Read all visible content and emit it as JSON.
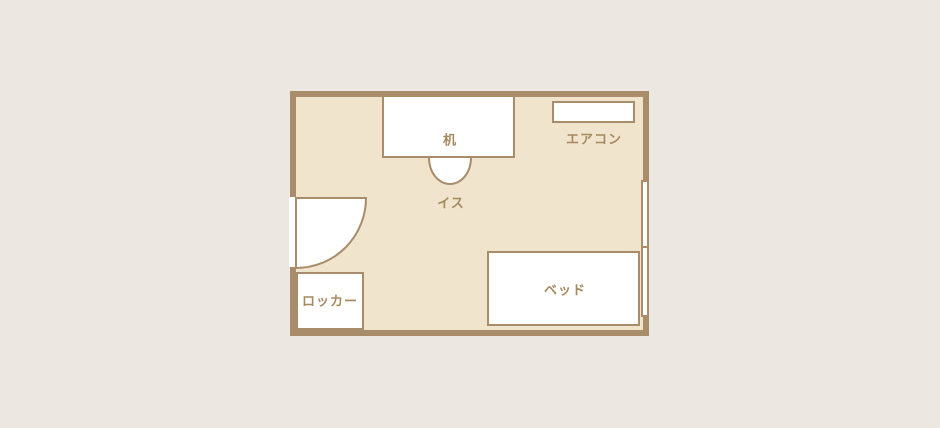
{
  "palette": {
    "page_background": "#ECE8E1",
    "floor_fill": "#F0E4CC",
    "wall_color": "#A98D6B",
    "furniture_fill": "#FFFFFF",
    "label_color": "#A6895F"
  },
  "floorplan": {
    "type": "single-room-layout",
    "furniture": {
      "desk": {
        "label": "机"
      },
      "chair": {
        "label": "イス"
      },
      "aircon": {
        "label": "エアコン"
      },
      "locker": {
        "label": "ロッカー"
      },
      "bed": {
        "label": "ベッド"
      }
    }
  }
}
